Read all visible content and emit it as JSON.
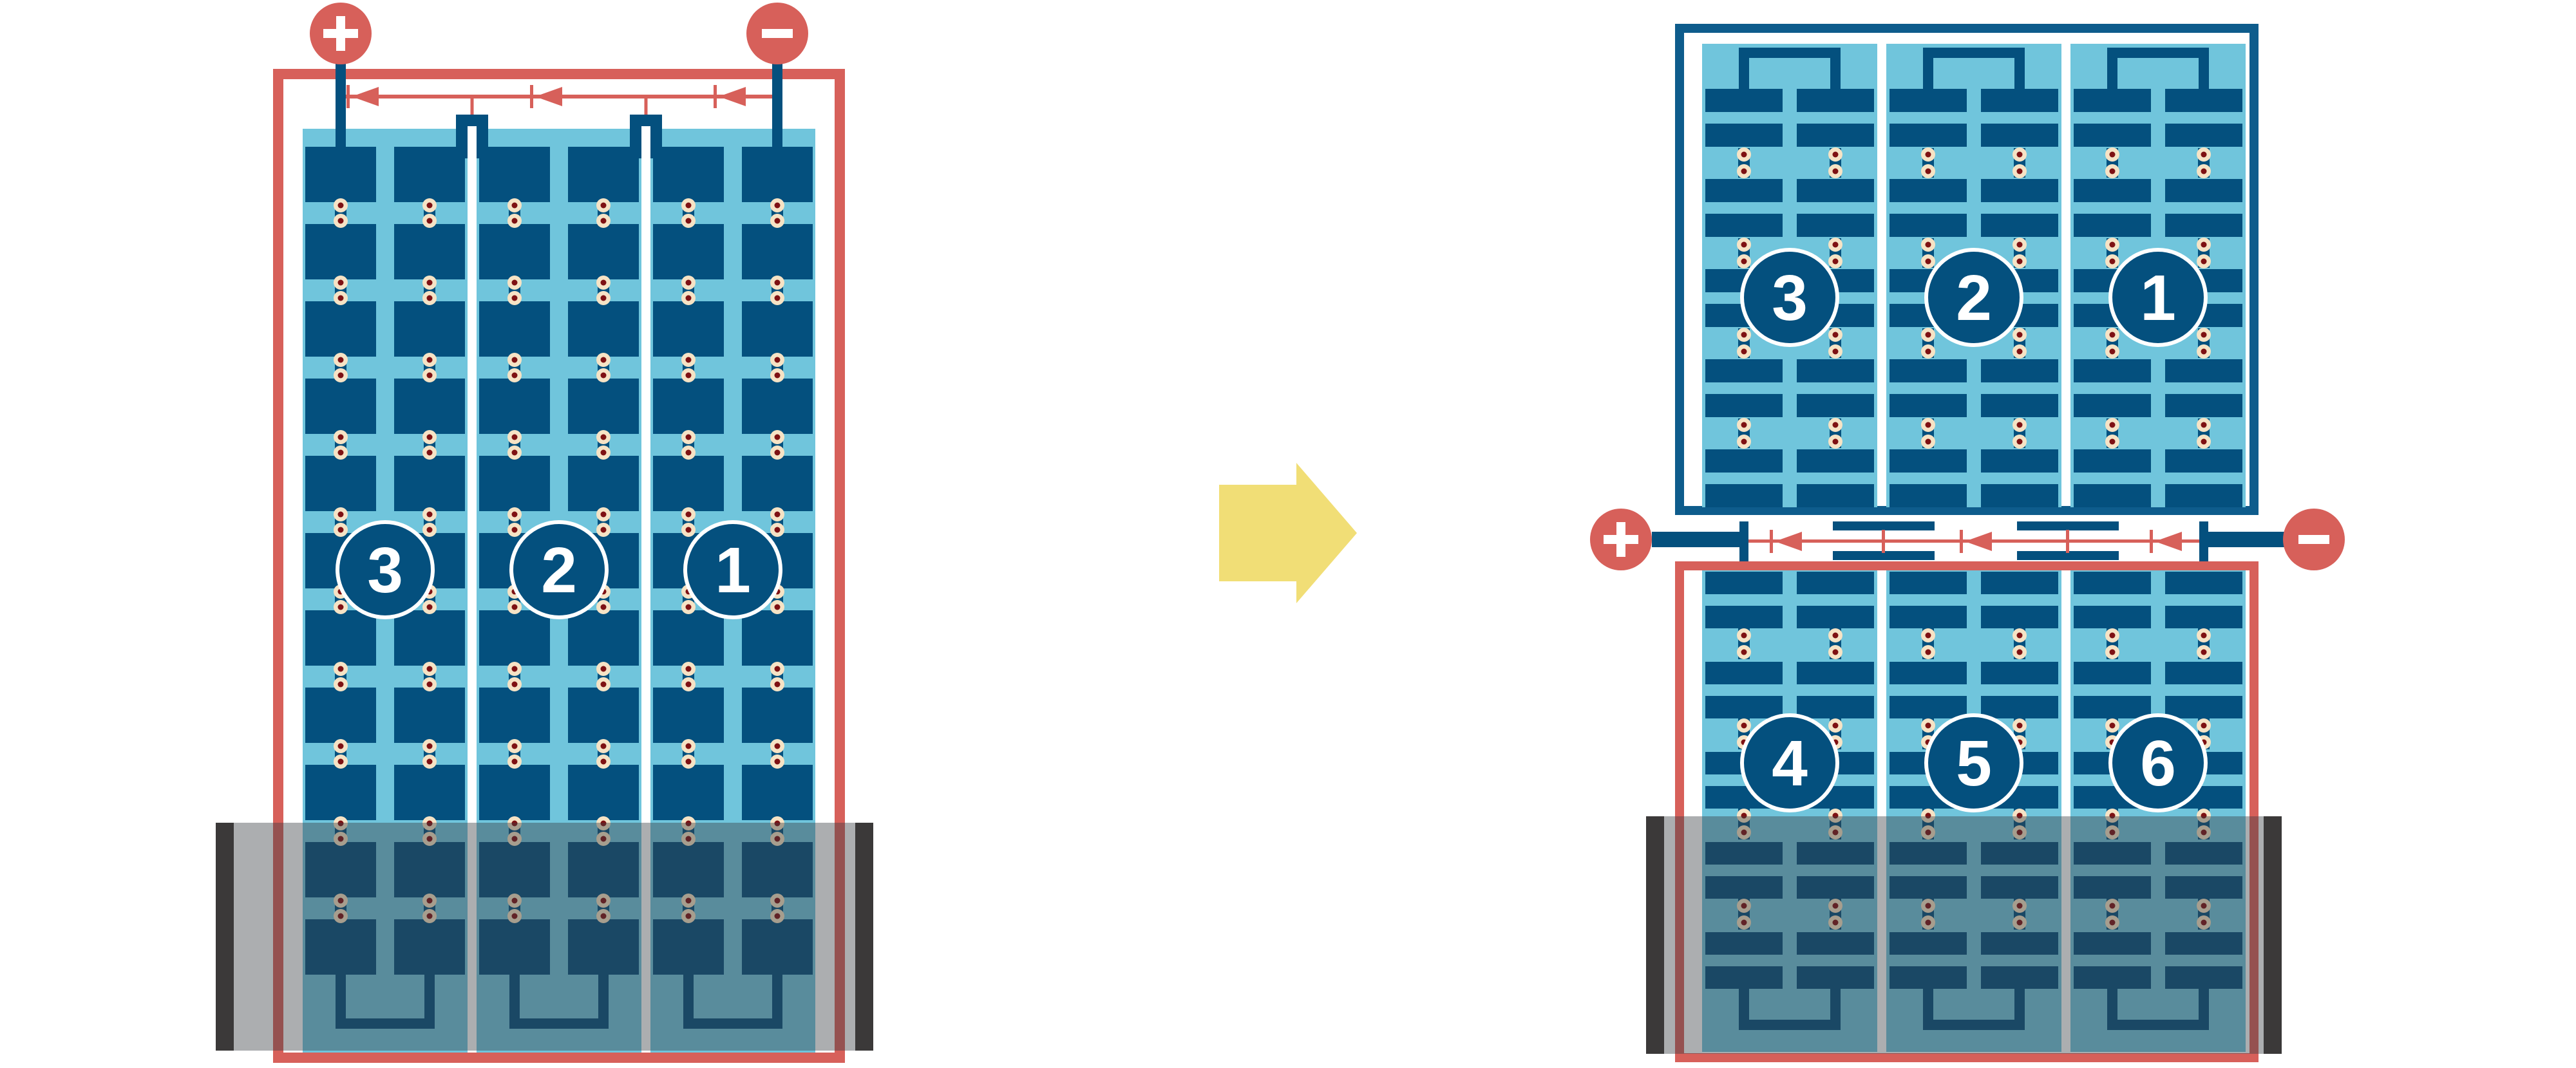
{
  "colors": {
    "cell_navy": "#04507E",
    "frame_blue": "#0E5C8C",
    "panel_light_blue": "#70C5DC",
    "wire_red": "#D7605A",
    "solder_cream": "#F6E3C5",
    "solder_maroon": "#7E1113",
    "arrow_yellow": "#F1DE76",
    "shade_bar_charcoal": "#3B3939",
    "shade_overlay": "rgba(58,62,66,0.42)",
    "label_text": "#FFFFFF",
    "background": "#FFFFFF"
  },
  "transform_arrow": {
    "direction": "right"
  },
  "left_module": {
    "kind": "full-cell module, strings in series, shaded bottom",
    "positive_label": "+",
    "negative_label": "−",
    "string_labels": [
      "3",
      "2",
      "1"
    ],
    "sections": 3,
    "columns_per_section": 2,
    "cell_rows": 11,
    "bypass_diodes": 3,
    "shade": {
      "present": true,
      "coverage": "bottom"
    }
  },
  "right_module": {
    "kind": "half-cut-cell module, split junction with bypass diodes in the middle, shaded bottom",
    "positive_label": "+",
    "negative_label": "−",
    "top_string_labels": [
      "3",
      "2",
      "1"
    ],
    "bottom_string_labels": [
      "4",
      "5",
      "6"
    ],
    "sections": 3,
    "columns_per_section": 2,
    "half_cell_groups_per_half": 5,
    "bypass_diodes": 3,
    "shade": {
      "present": true,
      "coverage": "bottom"
    }
  }
}
